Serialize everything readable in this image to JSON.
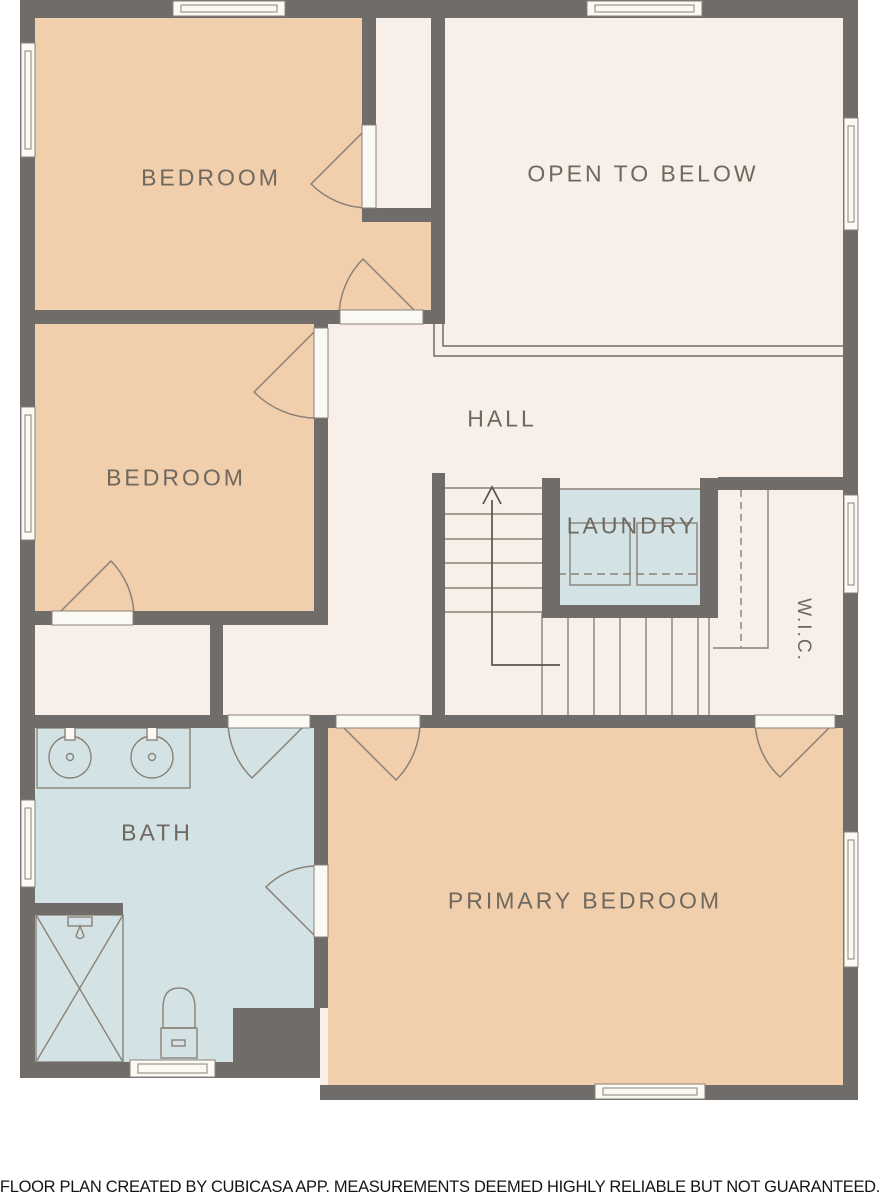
{
  "rooms": {
    "bedroom_top": {
      "label": "BEDROOM"
    },
    "open_to_below": {
      "label": "OPEN TO BELOW"
    },
    "bedroom_mid": {
      "label": "BEDROOM"
    },
    "hall": {
      "label": "HALL"
    },
    "laundry": {
      "label": "LAUNDRY"
    },
    "wic": {
      "label": "W.I.C."
    },
    "bath": {
      "label": "BATH"
    },
    "primary_bedroom": {
      "label": "PRIMARY BEDROOM"
    }
  },
  "footer": {
    "disclaimer": "FLOOR PLAN CREATED BY CUBICASA APP. MEASUREMENTS DEEMED HIGHLY RELIABLE BUT NOT GUARANTEED."
  },
  "colors": {
    "wall": "#6f6c69",
    "room_warm": "#f2cfac",
    "room_neutral": "#f7efe8",
    "room_wet": "#d3e3e5",
    "line": "#8a8276",
    "label_text": "#6e685e",
    "opening_fill": "#fbf9f4",
    "disclaimer_text": "#151515",
    "background": "#ffffff"
  }
}
